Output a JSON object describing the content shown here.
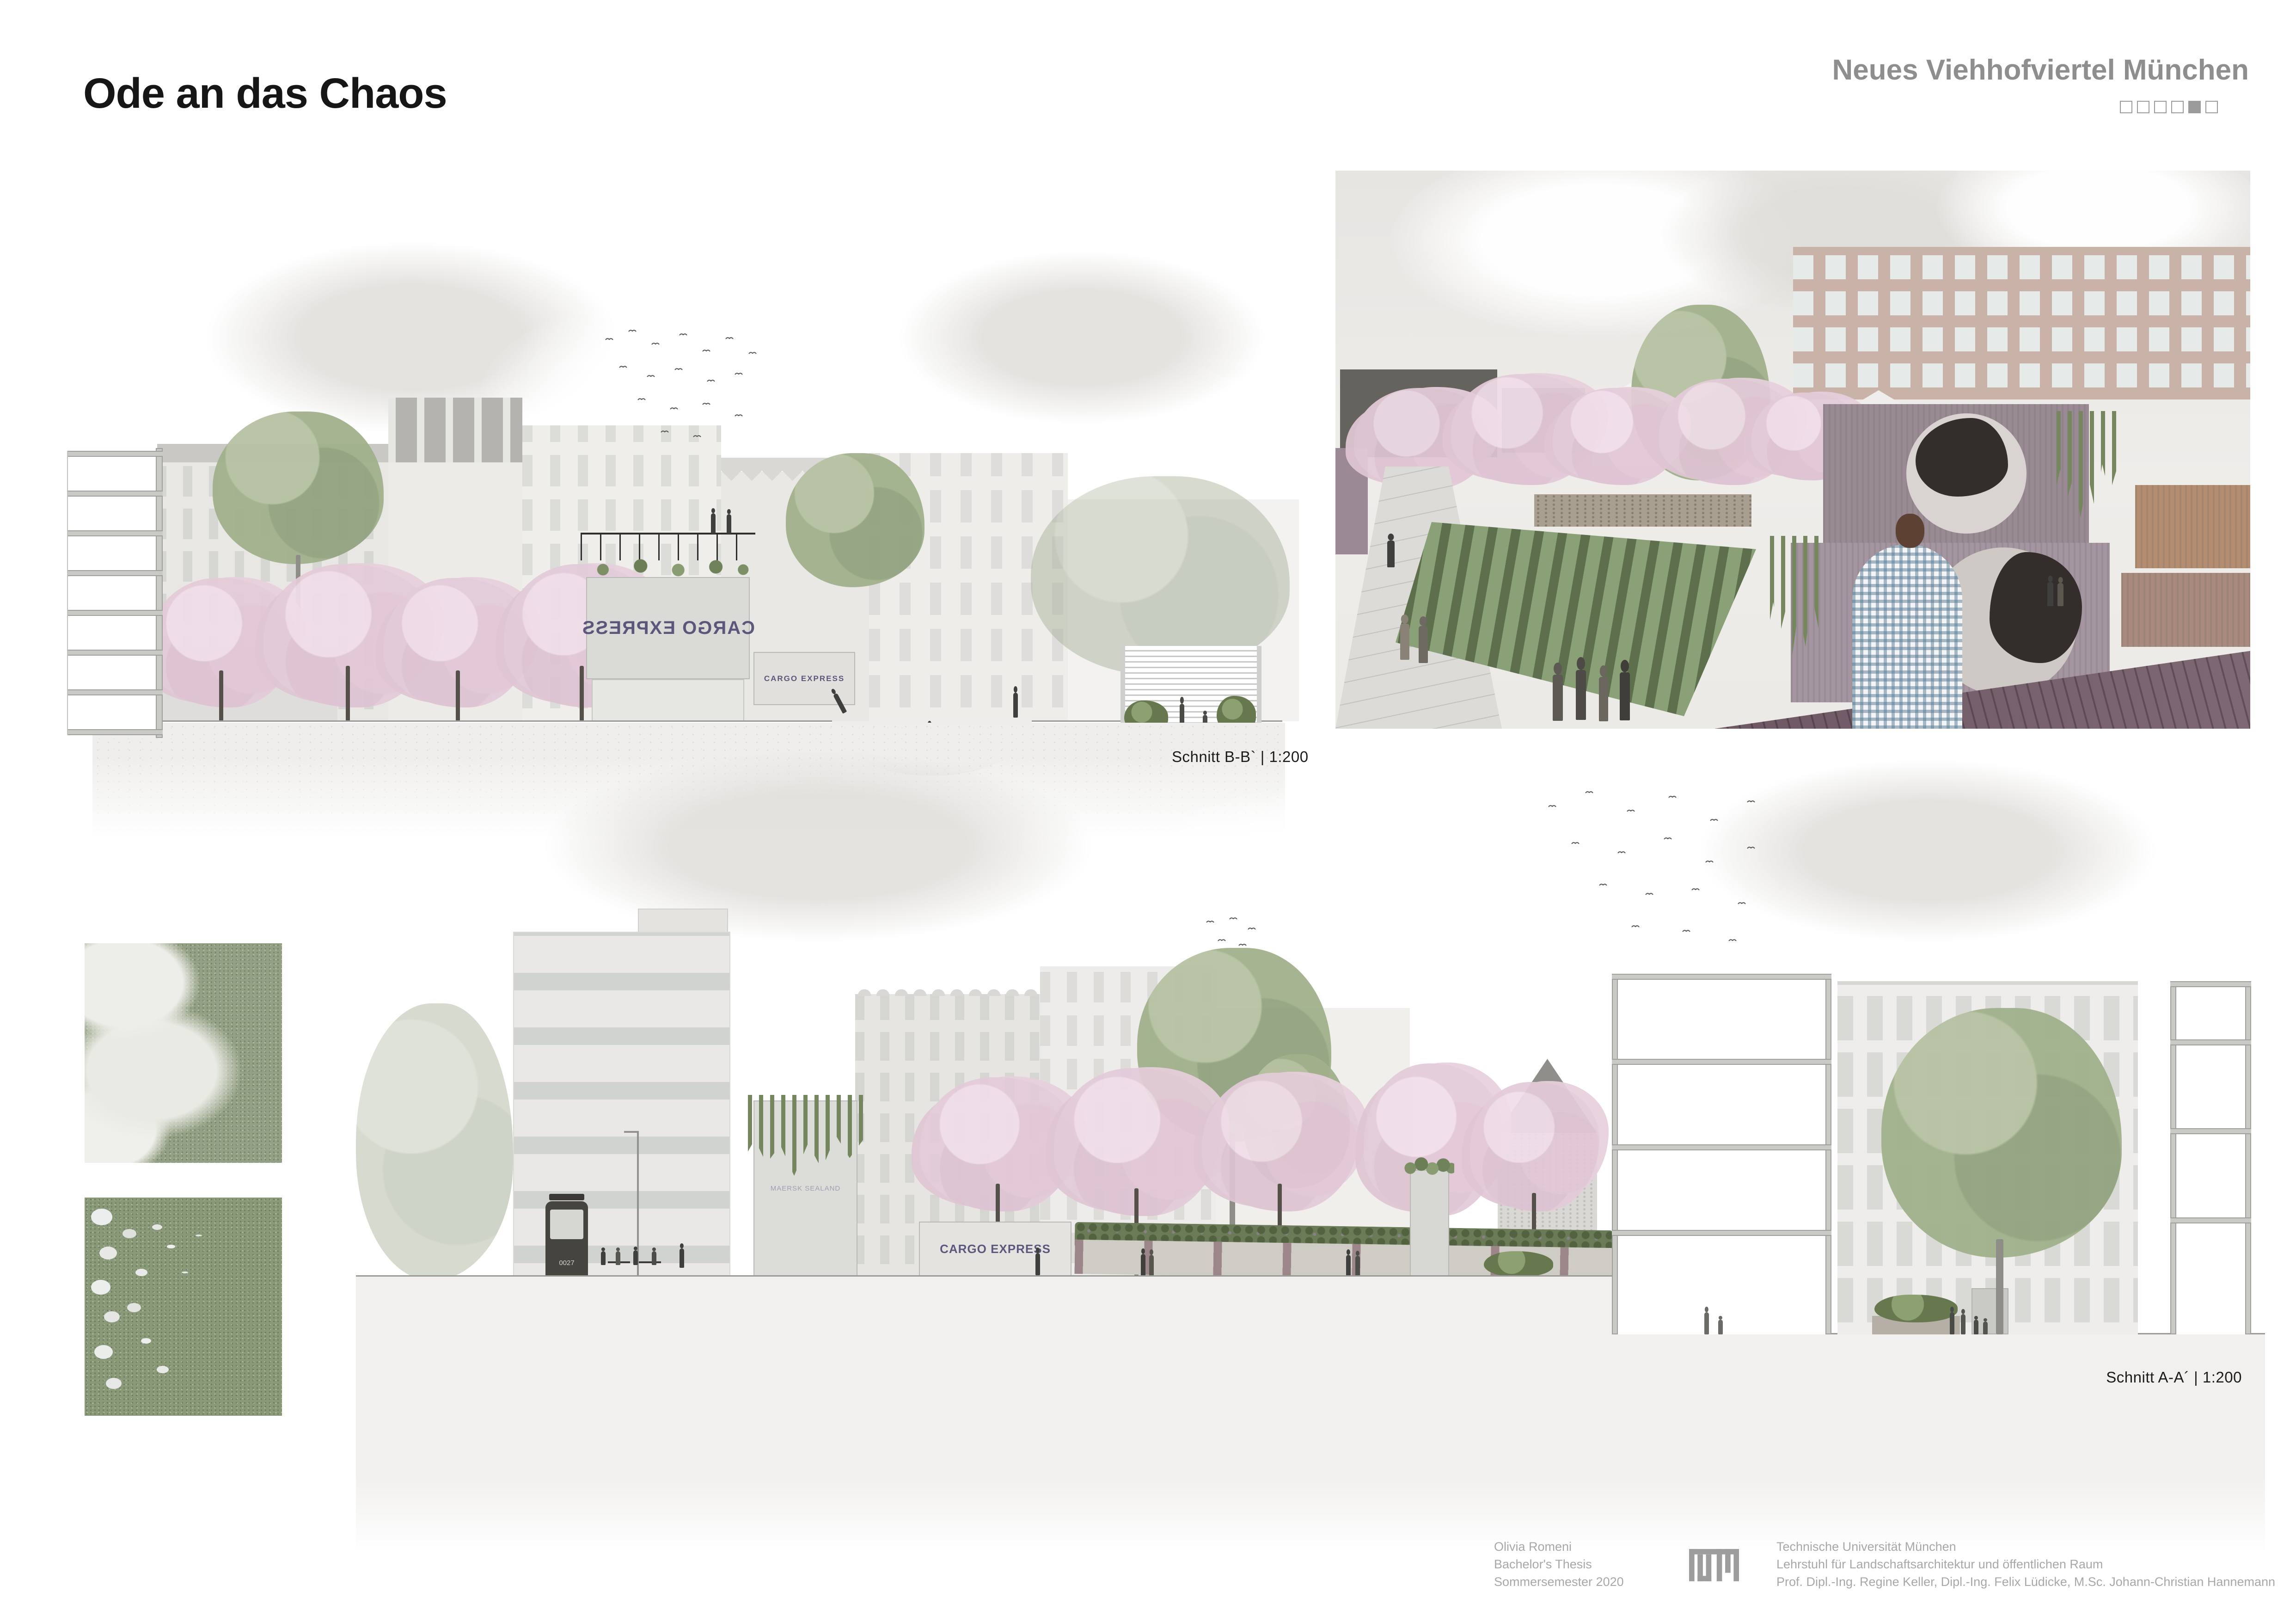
{
  "header": {
    "title": "Ode an das Chaos",
    "project_title": "Neues Viehhofviertel München",
    "page_indicator": {
      "total": 6,
      "active_index": 5
    }
  },
  "drawings": {
    "section_bb": {
      "label": "Schnitt B-B` | 1:200",
      "container_text": "CARGO EXPRESS",
      "container_text_mirrored": true
    },
    "section_aa": {
      "label": "Schnitt A-A´ | 1:200",
      "container_text": "CARGO EXPRESS",
      "container_brand": "MAERSK SEALAND",
      "tram_number": "0027"
    }
  },
  "credits": {
    "author": "Olivia Romeni",
    "thesis_type": "Bachelor's Thesis",
    "semester": "Sommersemester 2020",
    "university": "Technische Universität München",
    "chair": "Lehrstuhl für Landschaftsarchitektur und öffentlichen Raum",
    "supervisors": "Prof. Dipl.-Ing. Regine Keller, Dipl.-Ing. Felix Lüdicke, M.Sc. Johann-Christian Hannemann"
  },
  "colors": {
    "paper": "#ffffff",
    "heading_gray": "#8e8e8e",
    "credit_gray": "#a8a8a8",
    "blossom_pink": "#e4cbd9",
    "foliage_green": "#a2b18c",
    "container_mauve": "#9b8a95",
    "cargo_navy": "#403a66"
  }
}
